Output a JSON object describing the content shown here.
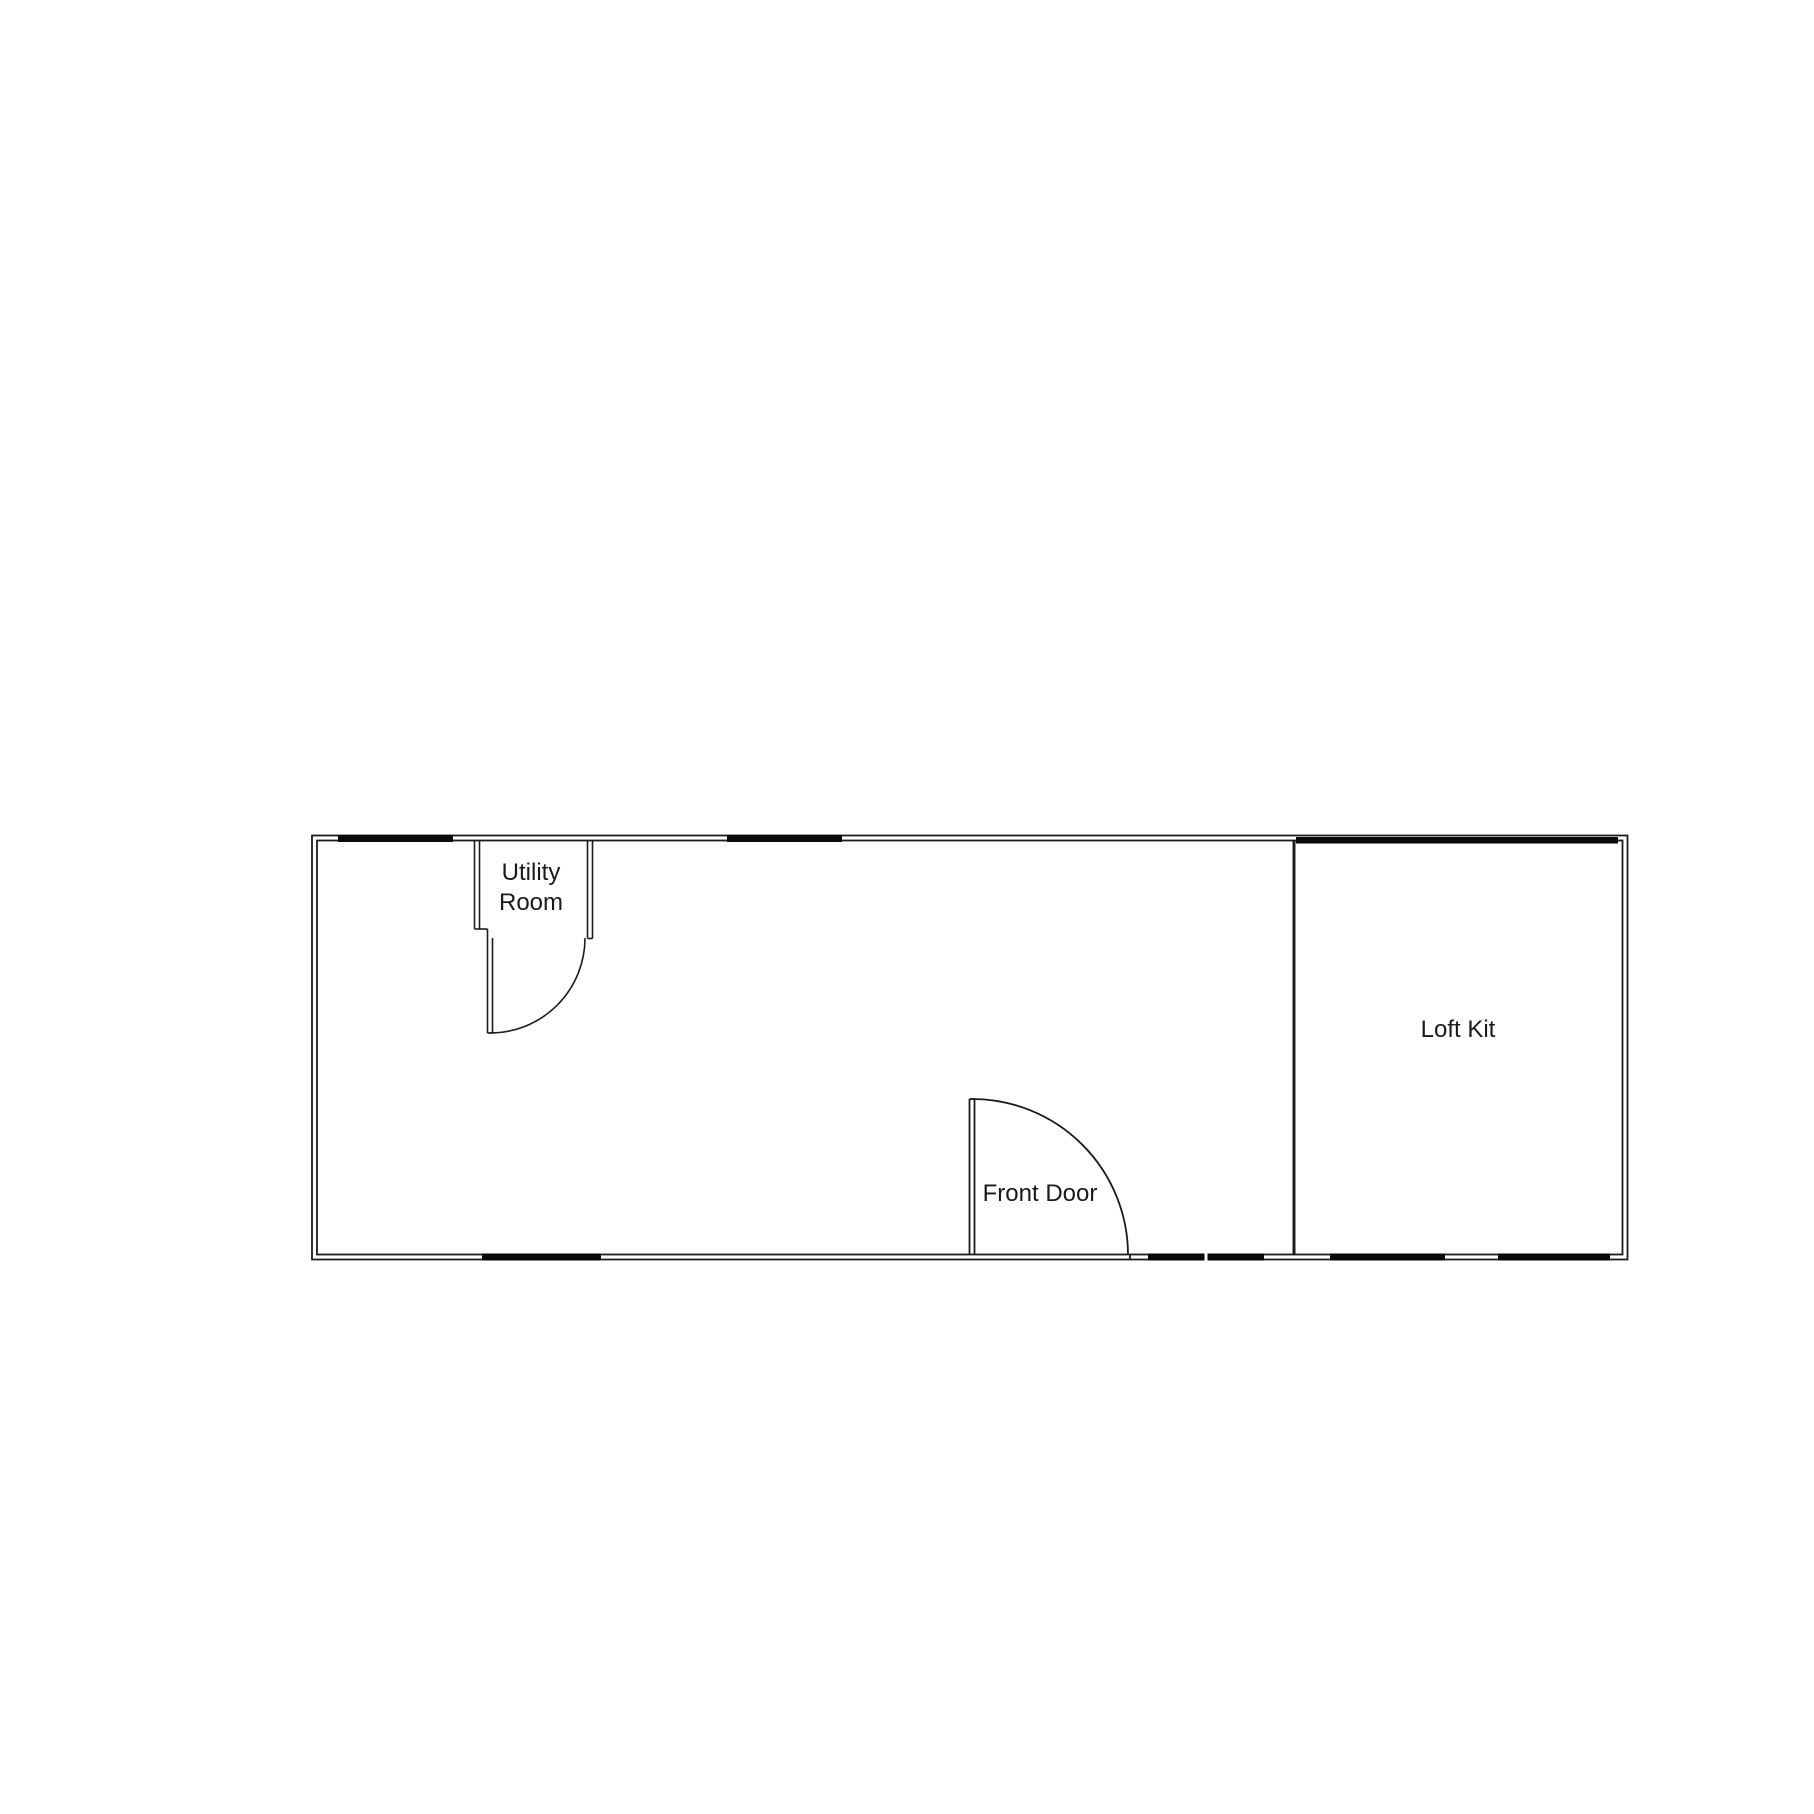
{
  "plan": {
    "background_color": "#ffffff",
    "wall_color": "#1b1b1b",
    "window_color": "#0a0a0a",
    "labels": {
      "utility_room_line1": "Utility",
      "utility_room_line2": "Room",
      "front_door": "Front Door",
      "loft_kit": "Loft Kit"
    }
  }
}
